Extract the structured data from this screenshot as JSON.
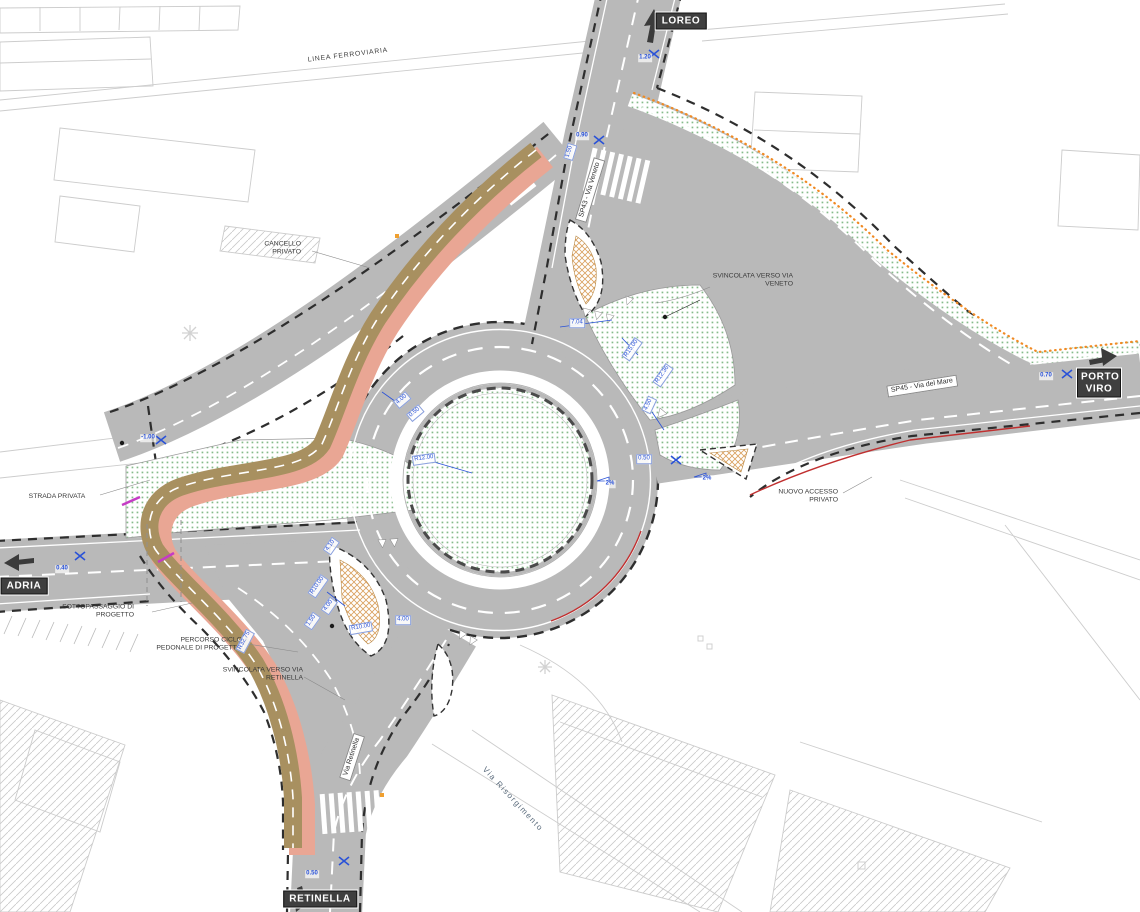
{
  "plan": {
    "destinations": {
      "north": "LOREO",
      "east": "PORTO VIRO",
      "west": "ADRIA",
      "south": "RETINELLA"
    },
    "road_names": {
      "sp43": "SP43 - Via Veneto",
      "sp45": "SP45 - Via del Mare",
      "retinella": "Via Retinella",
      "risorgimento": "Via Risorgimento"
    },
    "annotations": {
      "railway": "LINEA FERROVIARIA",
      "gate": "CANCELLO PRIVATO",
      "ramp_veneto": "SVINCOLATA VERSO VIA VENETO",
      "private_road": "STRADA PRIVATA",
      "underpass": "SOTTOPASSAGGIO DI PROGETTO",
      "cycle_path": "PERCORSO CICLO PEDONALE DI PROGETTO",
      "ramp_retinella": "SVINCOLATA VERSO VIA RETINELLA",
      "new_access": "NUOVO ACCESSO PRIVATO"
    },
    "dimensions": [
      {
        "t": "1.20"
      },
      {
        "t": "0.90"
      },
      {
        "t": "1.50"
      },
      {
        "t": "0.70"
      },
      {
        "t": "0.40"
      },
      {
        "t": "0.50"
      },
      {
        "t": "-1.00"
      },
      {
        "t": "R12.00"
      },
      {
        "t": "4.00"
      },
      {
        "t": "0.50"
      },
      {
        "t": "2%"
      },
      {
        "t": "2%"
      },
      {
        "t": "7.04"
      },
      {
        "t": "R15.00"
      },
      {
        "t": "R12.36"
      },
      {
        "t": "4.50"
      },
      {
        "t": "0.50"
      },
      {
        "t": "R10.00"
      },
      {
        "t": "4.00"
      },
      {
        "t": "1.50"
      },
      {
        "t": "R10.00"
      },
      {
        "t": "4.00"
      },
      {
        "t": "R32.75"
      },
      {
        "t": "4.10"
      }
    ],
    "colors": {
      "road_gray": "#b9b9b9",
      "cycle_brown": "#a89060",
      "pedestrian_pink": "#e9a694",
      "green_dots": "#86bb8a",
      "orange_dots": "#f08a24",
      "dimension_blue": "#2a52d8",
      "destination_box": "#3f3f3f",
      "red_curb": "#c03030"
    }
  }
}
